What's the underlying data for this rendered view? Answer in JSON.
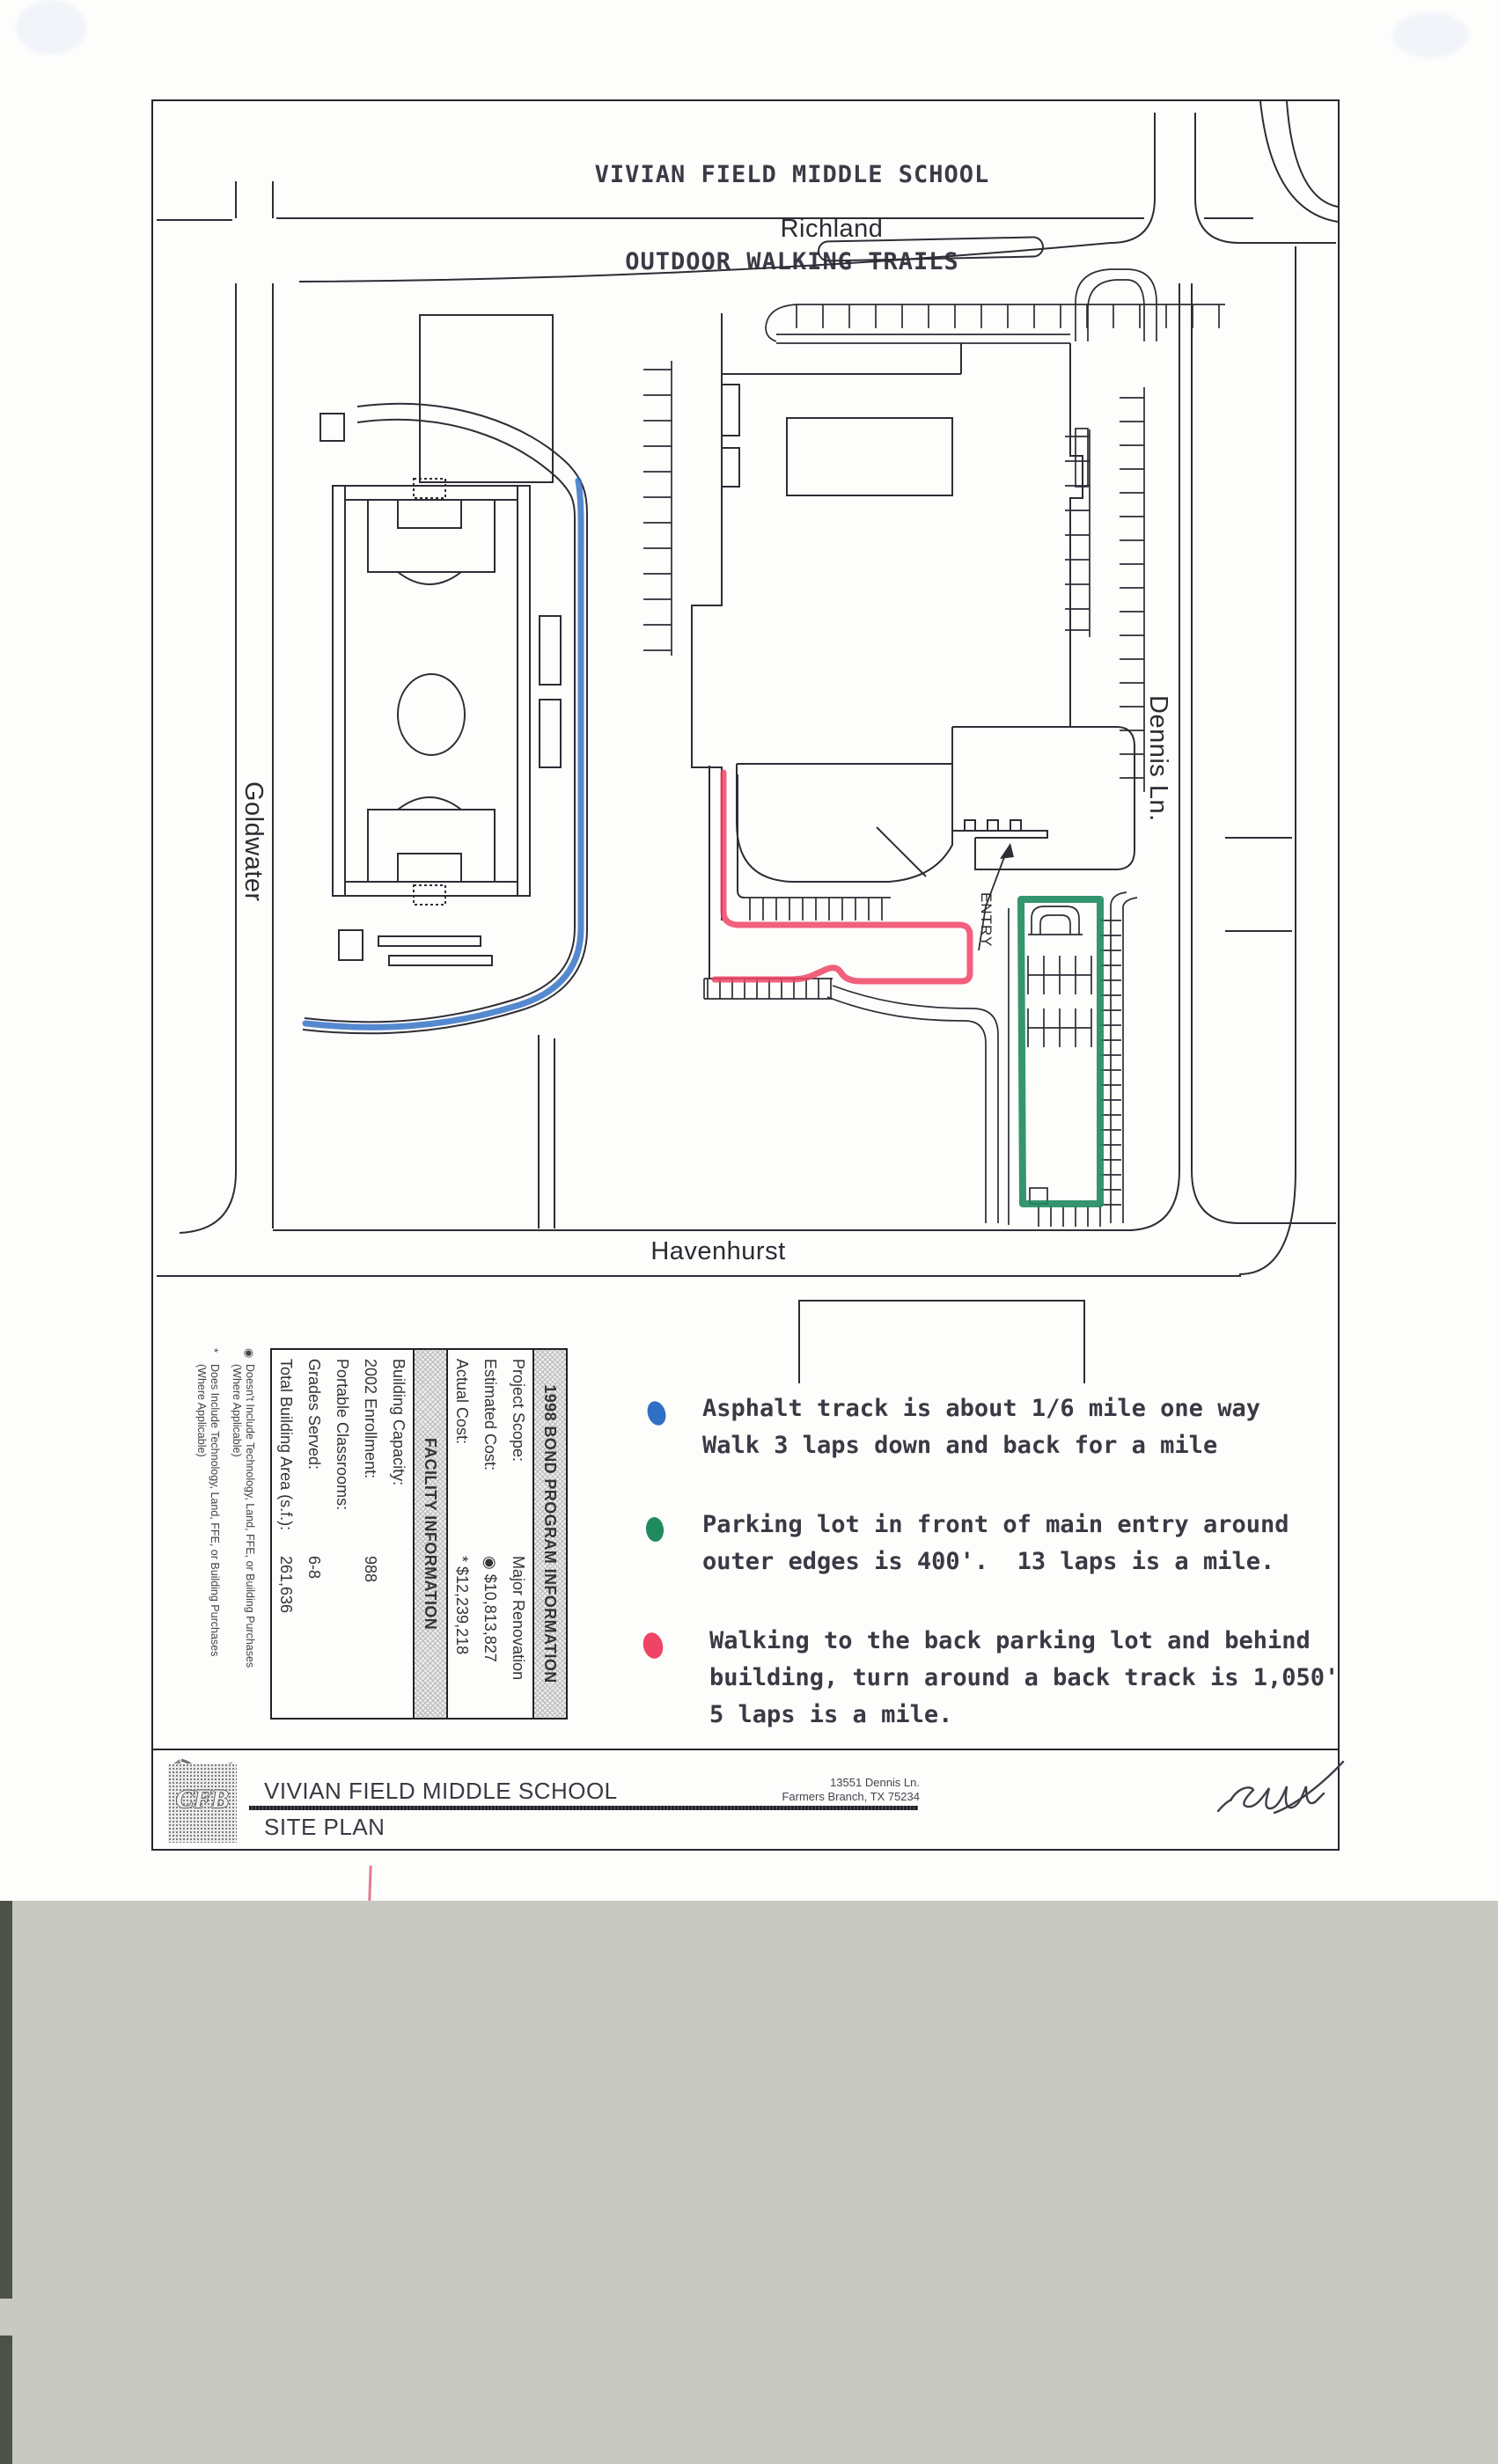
{
  "title": {
    "line1": "VIVIAN FIELD MIDDLE SCHOOL",
    "line2": "OUTDOOR WALKING TRAILS"
  },
  "map": {
    "street_top": "Richland",
    "street_left": "Goldwater",
    "street_right": "Dennis Ln.",
    "street_bottom": "Havenhurst",
    "entry_label": "ENTRY"
  },
  "colors": {
    "blue_trail": "#2f6fc4",
    "green_trail": "#1f8a5e",
    "red_trail": "#ef4465"
  },
  "legend": {
    "items": [
      {
        "dot": "blue-trail-dot",
        "color": "#2f6fc4",
        "lines": [
          "Asphalt track is about 1/6 mile one way",
          "Walk 3 laps down and back for a mile"
        ]
      },
      {
        "dot": "green-trail-dot",
        "color": "#1f8a5e",
        "lines": [
          "Parking lot in front of main entry around",
          "outer edges is 400'.  13 laps is a mile."
        ]
      },
      {
        "dot": "red-trail-dot",
        "color": "#ef4465",
        "lines": [
          "Walking to the back parking lot and behind",
          "building, turn around a back track is 1,050'",
          "5 laps is a mile."
        ]
      }
    ]
  },
  "info_table": {
    "bond_header": "1998 BOND PROGRAM INFORMATION",
    "bond_rows": [
      {
        "label": "Project Scope:",
        "value": "Major Renovation"
      },
      {
        "label": "Estimated Cost:",
        "value": "◉ $10,813,827"
      },
      {
        "label": "Actual Cost:",
        "value": "* $12,239,218"
      }
    ],
    "facility_header": "FACILITY INFORMATION",
    "facility_rows": [
      {
        "label": "Building Capacity:",
        "value": ""
      },
      {
        "label": "2002 Enrollment:",
        "value": "988"
      },
      {
        "label": "Portable Classrooms:",
        "value": ""
      },
      {
        "label": "Grades Served:",
        "value": "6-8"
      },
      {
        "label": "Total Building Area (s.f.):",
        "value": "261,636"
      }
    ],
    "footnotes": [
      {
        "symbol": "◉",
        "line1": "Doesn't Include Technology, Land, FFE, or Building Purchases",
        "line2": "(Where Applicable)"
      },
      {
        "symbol": "*",
        "line1": "Does Include Technology, Land, FFE, or Building Purchases",
        "line2": "(Where Applicable)"
      }
    ]
  },
  "footer": {
    "school_name": "VIVIAN FIELD MIDDLE SCHOOL",
    "sheet_name": "SITE PLAN",
    "address_line1": "13551 Dennis Ln.",
    "address_line2": "Farmers Branch, TX 75234",
    "logo_text": "CFB"
  }
}
